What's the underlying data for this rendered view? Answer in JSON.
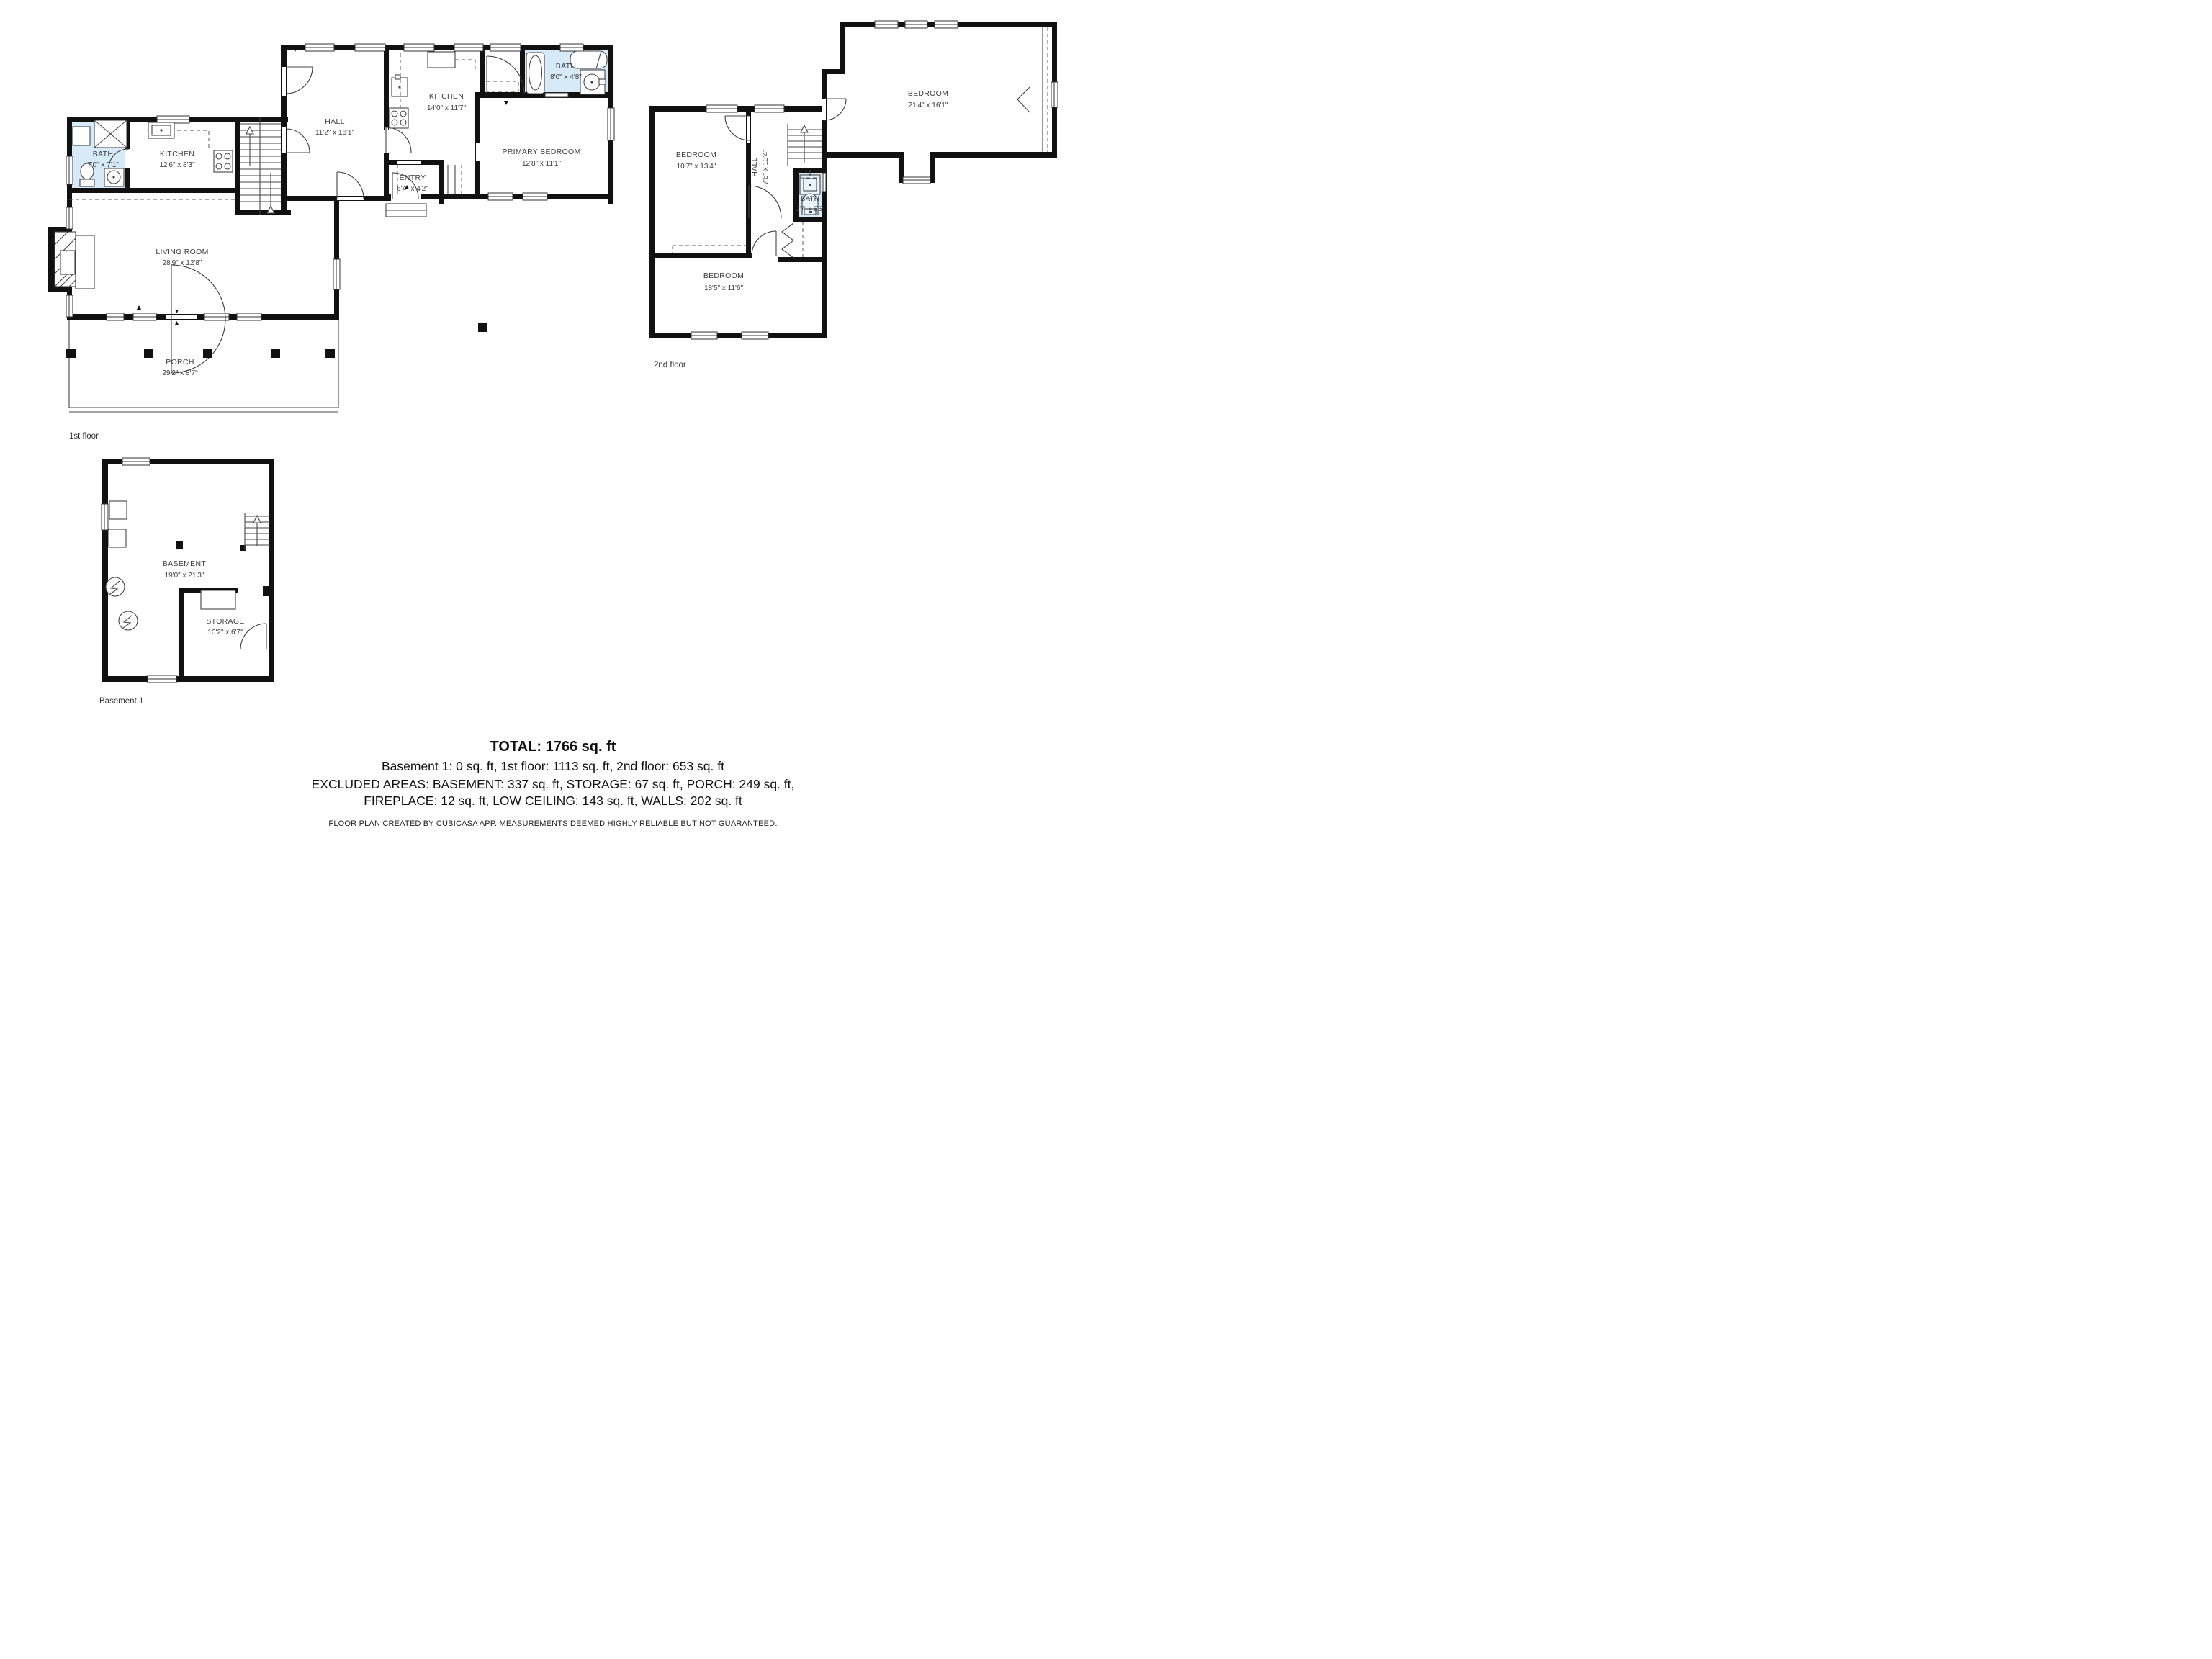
{
  "colors": {
    "wall": "#111111",
    "bath_fill": "#d7eaf8",
    "label_text": "#3e3e3e"
  },
  "floors": {
    "first": {
      "caption": "1st floor",
      "rooms": {
        "bath": {
          "name": "BATH",
          "dims": "7'0\" x 7'1\""
        },
        "kitchen_small": {
          "name": "KITCHEN",
          "dims": "12'6\" x 8'3\""
        },
        "hall": {
          "name": "HALL",
          "dims": "11'2\" x 16'1\""
        },
        "kitchen": {
          "name": "KITCHEN",
          "dims": "14'0\" x 11'7\""
        },
        "bath2": {
          "name": "BATH",
          "dims": "8'0\" x 4'8\""
        },
        "primary": {
          "name": "PRIMARY BEDROOM",
          "dims": "12'8\" x 11'1\""
        },
        "entry": {
          "name": "ENTRY",
          "dims": "6'4\" x 4'2\""
        },
        "living": {
          "name": "LIVING ROOM",
          "dims": "28'9\" x 12'8\""
        },
        "porch": {
          "name": "PORCH",
          "dims": "29'2\" x 8'7\""
        }
      }
    },
    "second": {
      "caption": "2nd floor",
      "rooms": {
        "bedroom_large": {
          "name": "BEDROOM",
          "dims": "21'4\" x 16'1\""
        },
        "bedroom_left": {
          "name": "BEDROOM",
          "dims": "10'7\" x 13'4\""
        },
        "hall": {
          "name": "HALL",
          "dims": "7'6\" x 13'4\""
        },
        "bath": {
          "name": "BATH",
          "dims": "2'7\" x 5'5\""
        },
        "bedroom_bottom": {
          "name": "BEDROOM",
          "dims": "18'5\" x 11'6\""
        }
      }
    },
    "basement": {
      "caption": "Basement 1",
      "rooms": {
        "basement": {
          "name": "BASEMENT",
          "dims": "19'0\" x 21'3\""
        },
        "storage": {
          "name": "STORAGE",
          "dims": "10'2\" x 6'7\""
        }
      }
    }
  },
  "summary": {
    "total": "TOTAL: 1766 sq. ft",
    "by_floor": "Basement 1: 0 sq. ft, 1st floor: 1113 sq. ft, 2nd floor: 653 sq. ft",
    "excluded_1": "EXCLUDED AREAS: BASEMENT: 337 sq. ft, STORAGE: 67 sq. ft, PORCH: 249 sq. ft,",
    "excluded_2": "FIREPLACE: 12 sq. ft, LOW CEILING: 143 sq. ft, WALLS: 202 sq. ft",
    "disclaimer": "FLOOR PLAN CREATED BY CUBICASA APP. MEASUREMENTS DEEMED HIGHLY RELIABLE BUT NOT GUARANTEED."
  }
}
